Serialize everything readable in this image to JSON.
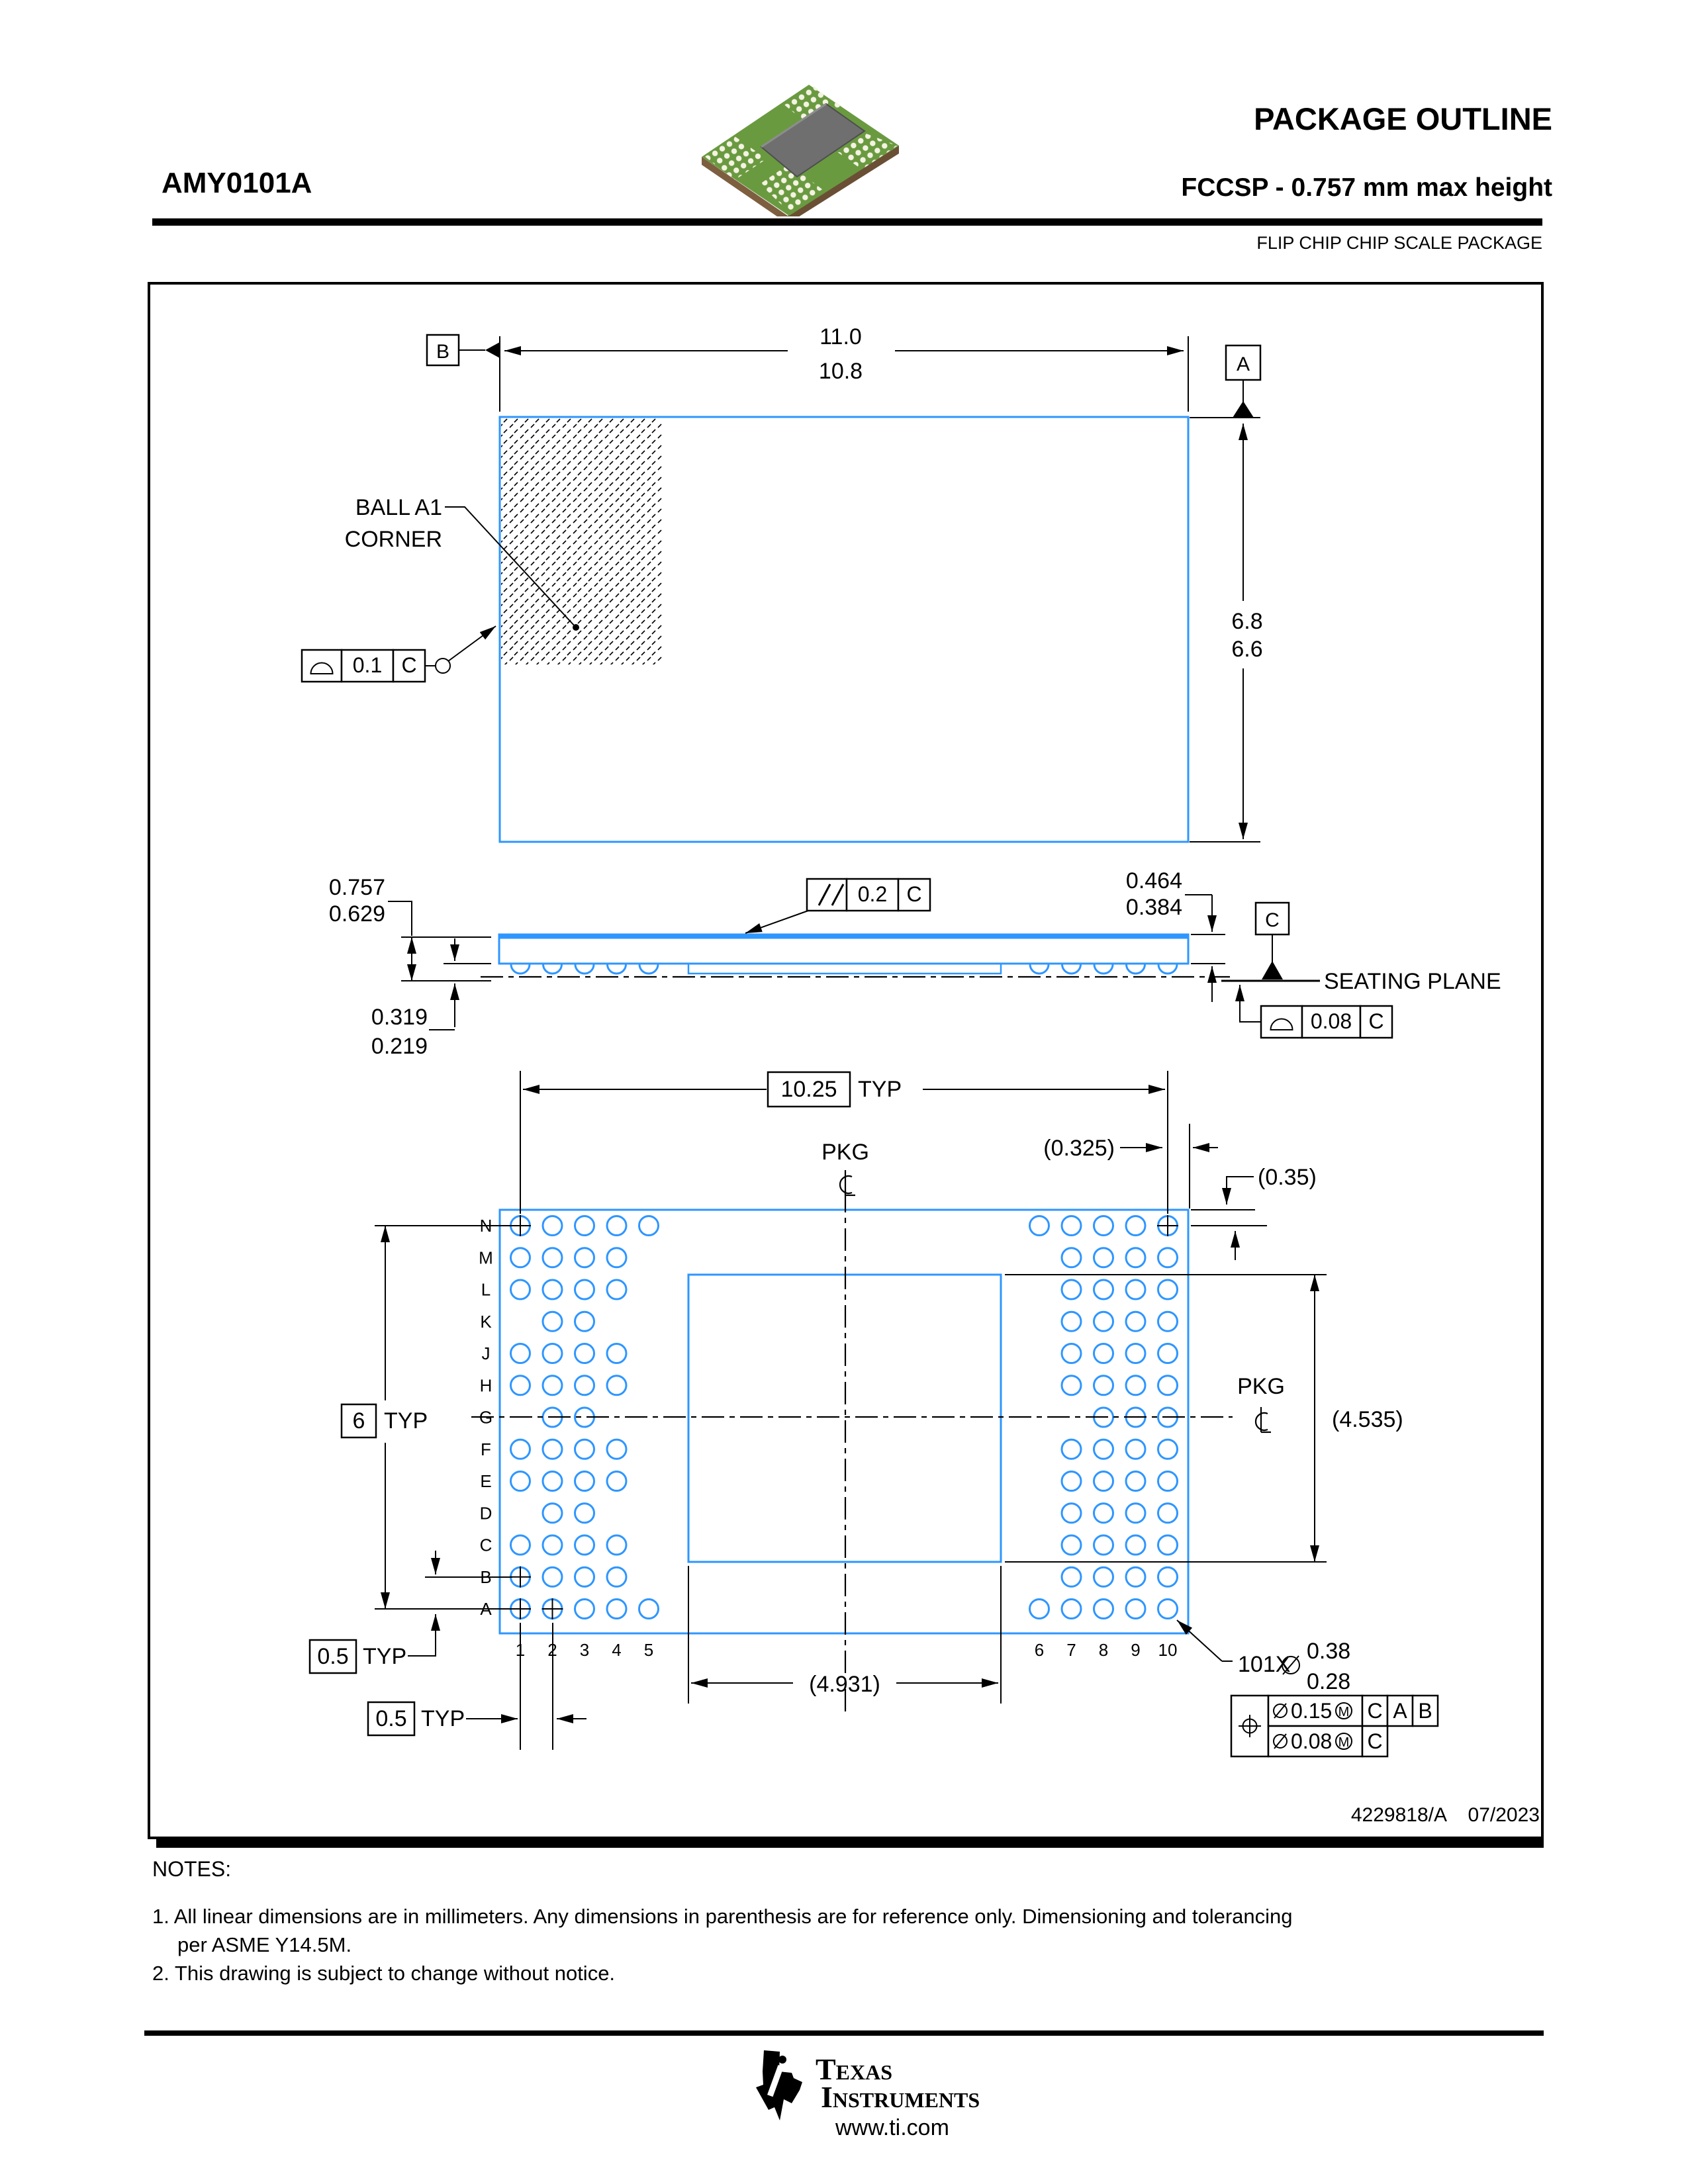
{
  "header": {
    "part_number": "AMY0101A",
    "title": "PACKAGE OUTLINE",
    "subtitle": "FCCSP - 0.757 mm max height",
    "package_type": "FLIP CHIP CHIP SCALE PACKAGE"
  },
  "doc": {
    "number": "4229818/A",
    "date": "07/2023"
  },
  "notes": {
    "heading": "NOTES:",
    "note1_line1": "1. All linear dimensions are in millimeters. Any dimensions in parenthesis are for reference only. Dimensioning and tolerancing",
    "note1_line2": "per ASME Y14.5M.",
    "note2": "2. This drawing is subject to change without notice."
  },
  "brand": {
    "name_line1": "Texas",
    "name_line2": "Instruments",
    "website": "www.ti.com"
  },
  "top_view": {
    "dim_width_max": "11.0",
    "dim_width_min": "10.8",
    "dim_height_max": "6.8",
    "dim_height_min": "6.6",
    "datum_a": "A",
    "datum_b": "B",
    "ball_a1_line1": "BALL A1",
    "ball_a1_line2": "CORNER",
    "flatness_value": "0.1",
    "flatness_datum": "C"
  },
  "side_view": {
    "height_max": "0.757",
    "height_min": "0.629",
    "standoff_max": "0.319",
    "standoff_min": "0.219",
    "thickness_max": "0.464",
    "thickness_min": "0.384",
    "parallelism_value": "0.2",
    "parallelism_datum": "C",
    "datum_c": "C",
    "seating_plane": "SEATING PLANE",
    "flatness_value": "0.08",
    "flatness_datum": "C"
  },
  "bottom_view": {
    "pitch_span": "10.25",
    "typ": "TYP",
    "margin_x": "(0.325)",
    "margin_y": "(0.35)",
    "pkg": "PKG",
    "rows_span": "6",
    "row_pitch": "0.5",
    "col_pitch": "0.5",
    "die_height": "(4.535)",
    "die_width": "(4.931)",
    "ball_callout_count": "101X",
    "ball_dia_max": "0.38",
    "ball_dia_min": "0.28",
    "columns": [
      "1",
      "2",
      "3",
      "4",
      "5",
      "6",
      "7",
      "8",
      "9",
      "10"
    ],
    "position_frame": {
      "tol1": "0.15",
      "tol1_datum1": "C",
      "tol1_datum2": "A",
      "tol1_datum3": "B",
      "tol2": "0.08",
      "tol2_datum": "C",
      "modifier": "M"
    }
  },
  "ball_map": {
    "rows": [
      {
        "label": "N",
        "cols": [
          1,
          2,
          3,
          4,
          5,
          6,
          7,
          8,
          9,
          10
        ]
      },
      {
        "label": "M",
        "cols": [
          1,
          2,
          3,
          4,
          7,
          8,
          9,
          10
        ]
      },
      {
        "label": "L",
        "cols": [
          1,
          2,
          3,
          4,
          7,
          8,
          9,
          10
        ]
      },
      {
        "label": "K",
        "cols": [
          2,
          3,
          7,
          8,
          9,
          10
        ]
      },
      {
        "label": "J",
        "cols": [
          1,
          2,
          3,
          4,
          7,
          8,
          9,
          10
        ]
      },
      {
        "label": "H",
        "cols": [
          1,
          2,
          3,
          4,
          7,
          8,
          9,
          10
        ]
      },
      {
        "label": "G",
        "cols": [
          2,
          3,
          8,
          9,
          10
        ]
      },
      {
        "label": "F",
        "cols": [
          1,
          2,
          3,
          4,
          7,
          8,
          9,
          10
        ]
      },
      {
        "label": "E",
        "cols": [
          1,
          2,
          3,
          4,
          7,
          8,
          9,
          10
        ]
      },
      {
        "label": "D",
        "cols": [
          2,
          3,
          7,
          8,
          9,
          10
        ]
      },
      {
        "label": "C",
        "cols": [
          1,
          2,
          3,
          4,
          7,
          8,
          9,
          10
        ]
      },
      {
        "label": "B",
        "cols": [
          1,
          2,
          3,
          4,
          7,
          8,
          9,
          10
        ]
      },
      {
        "label": "A",
        "cols": [
          1,
          2,
          3,
          4,
          5,
          6,
          7,
          8,
          9,
          10
        ]
      }
    ],
    "crosshair_balls": [
      "N1",
      "N10",
      "B1",
      "A1",
      "A2"
    ]
  }
}
